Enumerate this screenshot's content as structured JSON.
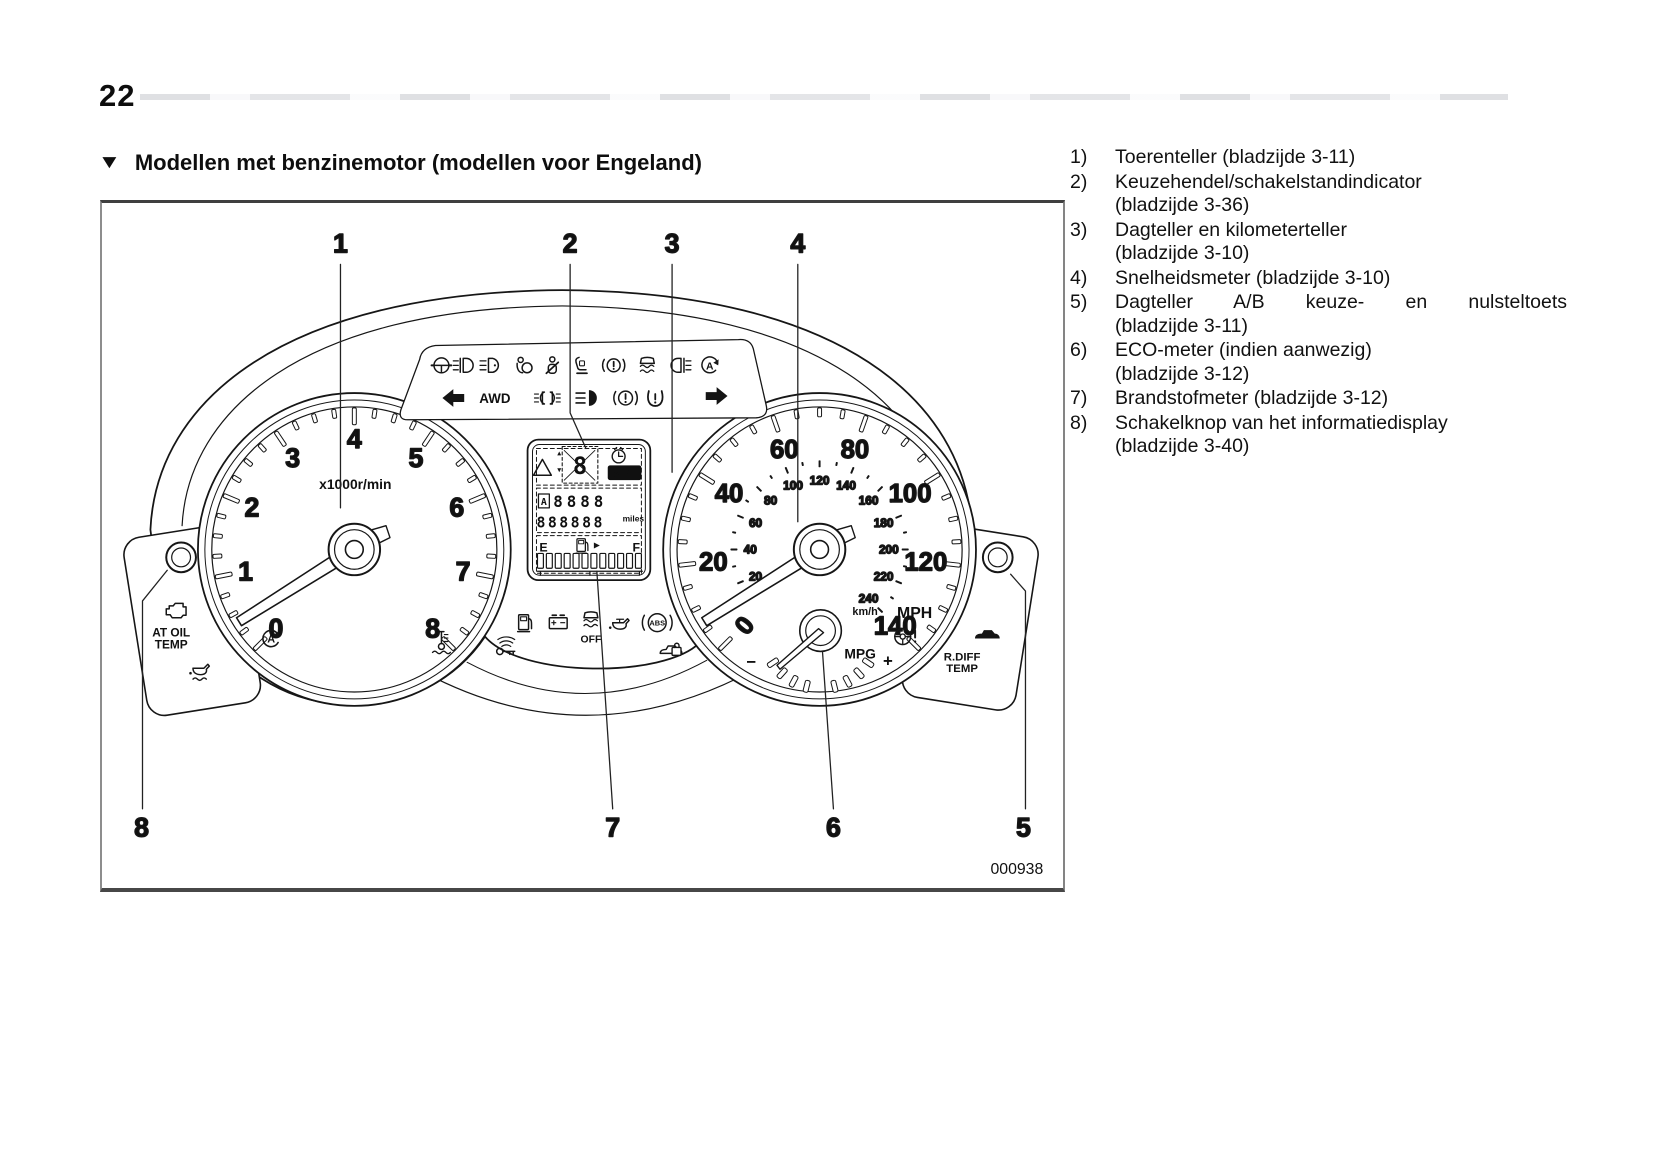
{
  "page": {
    "number": "22"
  },
  "section": {
    "marker": "▼",
    "title": "Modellen met benzinemotor (modellen voor Engeland)"
  },
  "figure": {
    "code": "000938",
    "callouts": [
      "1",
      "2",
      "3",
      "4",
      "5",
      "6",
      "7",
      "8"
    ]
  },
  "legend": {
    "items": [
      {
        "num": "1)",
        "lines": [
          "Toerenteller (bladzijde 3-11)"
        ]
      },
      {
        "num": "2)",
        "lines": [
          "Keuzehendel/schakelstandindicator",
          "(bladzijde 3-36)"
        ]
      },
      {
        "num": "3)",
        "lines": [
          "Dagteller en kilometerteller",
          "(bladzijde 3-10)"
        ]
      },
      {
        "num": "4)",
        "lines": [
          "Snelheidsmeter (bladzijde 3-10)"
        ]
      },
      {
        "num": "5)",
        "lines": [
          "Dagteller A/B keuze- en nulsteltoets",
          "(bladzijde 3-11)"
        ]
      },
      {
        "num": "6)",
        "lines": [
          "ECO-meter (indien aanwezig)",
          "(bladzijde 3-12)"
        ]
      },
      {
        "num": "7)",
        "lines": [
          "Brandstofmeter (bladzijde 3-12)"
        ]
      },
      {
        "num": "8)",
        "lines": [
          "Schakelknop van het informatiedisplay",
          "(bladzijde 3-40)"
        ]
      }
    ]
  },
  "cluster": {
    "tachometer": {
      "unit": "x1000r/min",
      "min": 0,
      "max": 8,
      "labels": [
        "0",
        "1",
        "2",
        "3",
        "4",
        "5",
        "6",
        "7",
        "8"
      ]
    },
    "speedometer": {
      "outer_unit": "MPH",
      "inner_unit": "km/h",
      "mph_labels": [
        "0",
        "20",
        "40",
        "60",
        "80",
        "100",
        "120",
        "140"
      ],
      "mph_max": 140,
      "kmh_labels": [
        "20",
        "40",
        "60",
        "80",
        "100",
        "120",
        "140",
        "160",
        "180",
        "200",
        "220",
        "240"
      ],
      "kmh_max": 240
    },
    "eco_meter": {
      "label": "MPG",
      "plus": "+",
      "minus": "−"
    },
    "display": {
      "set_label": "SET",
      "gear_char": "8",
      "trip_prefix": "A",
      "trip_digits": "8888",
      "odometer_digits": "888888",
      "distance_unit": "miles",
      "fuel_empty": "E",
      "fuel_full": "F"
    },
    "indicators": {
      "awd": "AWD",
      "off": "OFF",
      "abs": "ABS"
    },
    "auto_letter": "A",
    "left_pod": {
      "line1": "AT OIL",
      "line2": "TEMP"
    },
    "right_pod": {
      "line1": "R.DIFF",
      "line2": "TEMP"
    }
  },
  "colors": {
    "ink": "#141414",
    "paper": "#ffffff",
    "lcd_badge": "#101010"
  }
}
